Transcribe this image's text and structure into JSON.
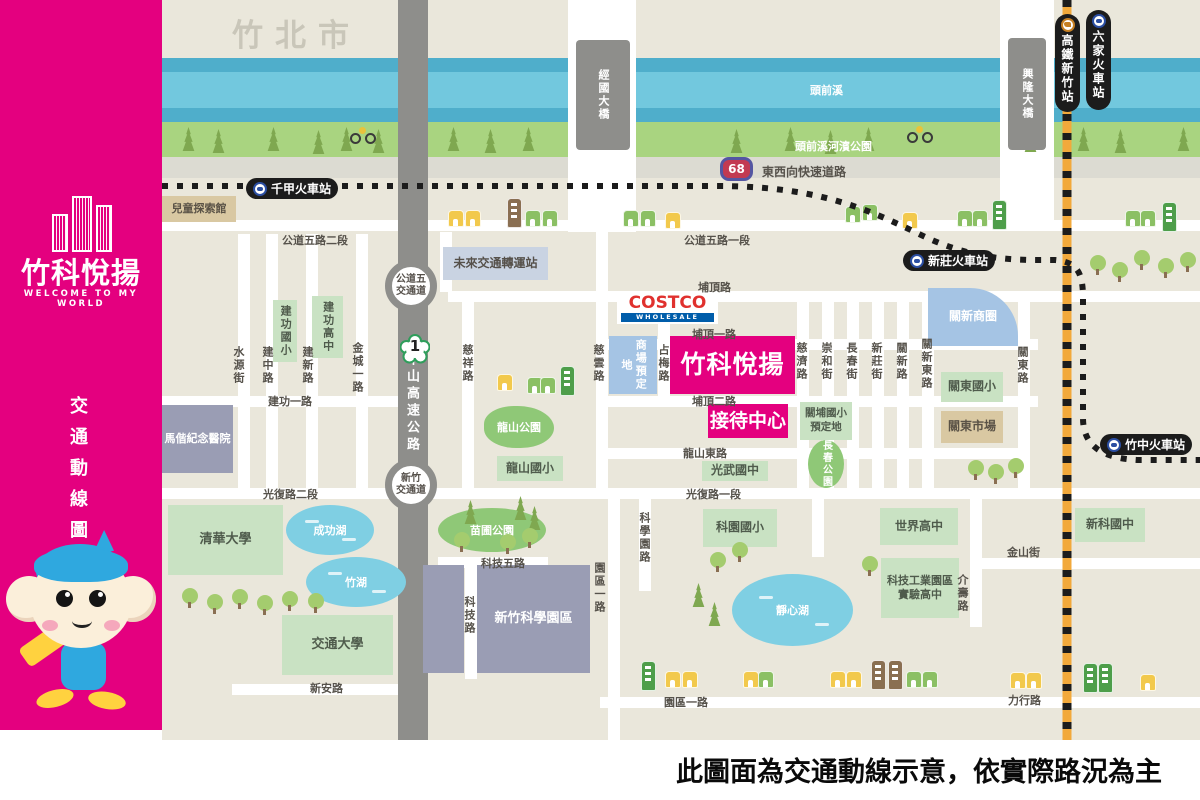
{
  "colors": {
    "brand_pink": "#E4007F",
    "map_bg": "#EAE7DB",
    "river_blue": "#72C8DE",
    "river_band_blue": "#4FAECB",
    "riverside_green": "#A9D480",
    "road_gray": "#8E8E8B",
    "rail_orange": "#F2A93B",
    "rail_black": "#1C1C1C",
    "school_green": "#C9E2C3",
    "park_green": "#8FC877",
    "lake_blue": "#7FCFE3",
    "building_gray": "#9A9DB4",
    "commercial_blue": "#A5C4E4",
    "tan": "#D9C8A2",
    "costco_red": "#E0312E",
    "costco_blue": "#005DAA"
  },
  "sidebar": {
    "brand_name": "竹科悅揚",
    "brand_tagline": "WELCOME TO MY WORLD",
    "map_title": "交通動線圖",
    "mascot": "monkey-mascot"
  },
  "footer": {
    "disclaimer": "此圖面為交通動線示意，依實際路況為主"
  },
  "map": {
    "city": "竹北市",
    "river": "頭前溪",
    "riverside_park": "頭前溪河濱公園",
    "expressway_no": "68",
    "expressway": "東西向快速道路",
    "highway_no": "1",
    "highway": "中山高速公路",
    "ic_gongdao_1": "公道五",
    "ic_gongdao_2": "交通道",
    "ic_hsinchu_1": "新竹",
    "ic_hsinchu_2": "交通道",
    "bridge_jingguo": "經國大橋",
    "bridge_xinglong": "興隆大橋",
    "st_qianjia": "千甲火車站",
    "st_xinzhuang": "新莊火車站",
    "st_zhuzhong": "竹中火車站",
    "st_hsr": "高鐵新竹站",
    "st_liujia": "六家火車站",
    "project": "竹科悅揚",
    "reception": "接待中心",
    "costco_1": "COSTCO",
    "costco_2": "WHOLESALE",
    "mall_site": "商場預定地",
    "guanxin_biz": "關新商圈",
    "transit_hub": "未來交通轉運站",
    "kids_museum": "兒童探索館",
    "hospital": "馬偕紀念醫院",
    "sch_jiangong_e": "建功國小",
    "sch_jiangong_h": "建功高中",
    "sch_longshan": "龍山國小",
    "sch_guangwu": "光武國中",
    "sch_keyuan": "科園國小",
    "sch_world": "世界高中",
    "sch_exp_1": "科技工業園區",
    "sch_exp_2": "實驗高中",
    "sch_xinke": "新科國中",
    "sch_guandong": "關東國小",
    "sch_guanpu_1": "關埔國小",
    "sch_guanpu_2": "預定地",
    "univ_nthu": "清華大學",
    "univ_nctu": "交通大學",
    "mkt_guandong": "關東市場",
    "science_park": "新竹科學園區",
    "lake_chenggong": "成功湖",
    "lake_zhu": "竹湖",
    "lake_jingxin": "靜心湖",
    "park_longshan": "龍山公園",
    "park_miaopu": "苗圃公園",
    "park_changchun": "長春公園",
    "rd_gongdao5_2": "公道五路二段",
    "rd_gongdao5_1": "公道五路一段",
    "rd_puding": "埔頂路",
    "rd_puding_1": "埔頂一路",
    "rd_puding_2": "埔頂二路",
    "rd_jiangong_1": "建功一路",
    "rd_longshan_e": "龍山東路",
    "rd_guangfu_2": "光復路二段",
    "rd_guangfu_1": "光復路一段",
    "rd_keji_5": "科技五路",
    "rd_jinshan": "金山街",
    "rd_xinan": "新安路",
    "rd_yuanqu_1": "園區一路",
    "rd_lixing": "力行路",
    "rd_shuiyuan": "水源街",
    "rd_jianzhong": "建中路",
    "rd_jianxin": "建新路",
    "rd_jincheng_1": "金城一路",
    "rd_cixiang": "慈祥路",
    "rd_ciyun": "慈雲路",
    "rd_zhanmei": "占梅路",
    "rd_ciji": "慈濟路",
    "rd_chonghe": "崇和街",
    "rd_changchun": "長春街",
    "rd_xinzhuang": "新莊街",
    "rd_guanxin": "關新路",
    "rd_guanxin_e": "關新東路",
    "rd_guandong": "關東路",
    "rd_kexueyuan": "科學園路",
    "rd_yuanqu_1v": "園區一路",
    "rd_keji": "科技路",
    "rd_jieshou": "介壽路"
  }
}
